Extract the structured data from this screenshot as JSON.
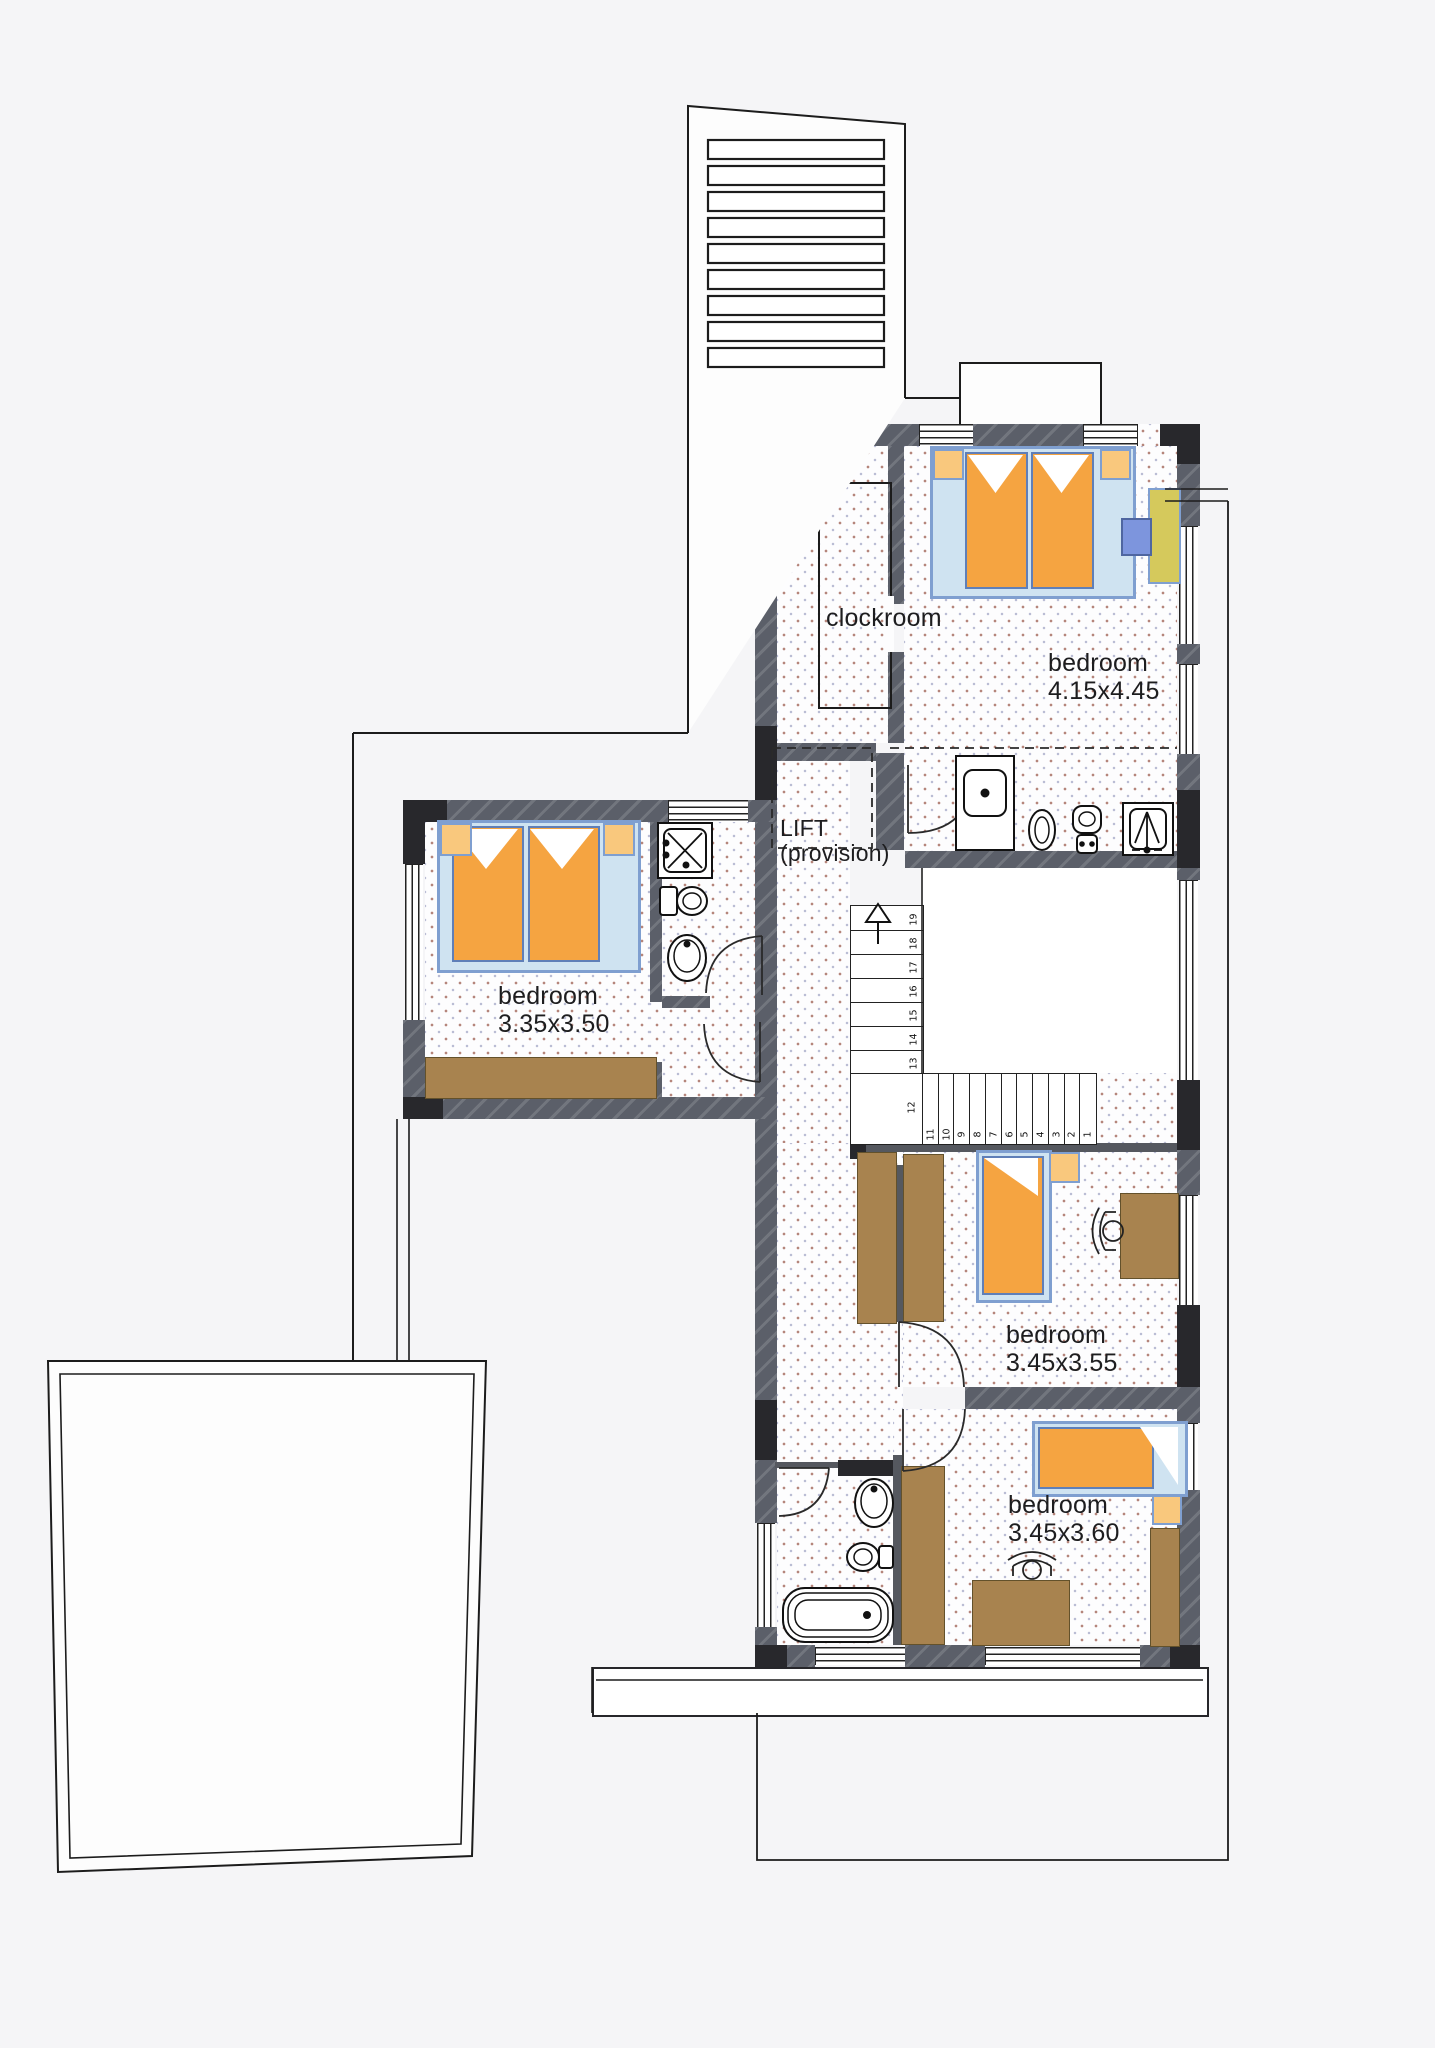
{
  "plan_type": "floor plan",
  "rooms": {
    "clockroom": {
      "name": "clockroom"
    },
    "bedroom_master": {
      "name": "bedroom",
      "size": "4.15x4.45"
    },
    "bedroom_left": {
      "name": "bedroom",
      "size": "3.35x3.50"
    },
    "bedroom_middle": {
      "name": "bedroom",
      "size": "3.45x3.55"
    },
    "bedroom_bottom": {
      "name": "bedroom",
      "size": "3.45x3.60"
    },
    "lift": {
      "name": "LIFT",
      "note": "(provision)"
    }
  },
  "stairs": {
    "lower_flight_numbers": [
      "1",
      "2",
      "3",
      "4",
      "5",
      "6",
      "7",
      "8",
      "9",
      "10",
      "11"
    ],
    "landing_number": "12",
    "upper_flight_numbers": [
      "13",
      "14",
      "15",
      "16",
      "17",
      "18",
      "19"
    ],
    "direction": "up"
  },
  "colors": {
    "wall": "#5b5f69",
    "wall_corner": "#28282c",
    "mattress_orange": "#f5a441",
    "nightstand_orange": "#f9c87d",
    "bed_frame_blue": "#7f9fd0",
    "furniture_brown": "#a8834f",
    "desk_olive": "#d5c95c",
    "chair_blue": "#7d95dd",
    "floor_dot_warm": "#a87064",
    "floor_dot_cool": "#8a8fb6",
    "line": "#1c1c1c"
  }
}
